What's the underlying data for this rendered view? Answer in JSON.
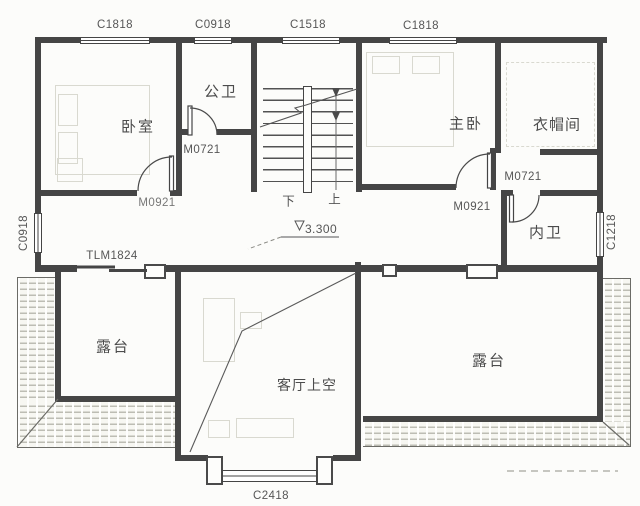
{
  "windows": {
    "top_1": "C1818",
    "top_2": "C0918",
    "top_3": "C1518",
    "top_4": "C1818",
    "left": "C0918",
    "right": "C1218",
    "bottom": "C2418"
  },
  "doors": {
    "public_bath": "M0721",
    "bedroom": "M0921",
    "master": "M0921",
    "ensuite": "M0721",
    "terrace_slide": "TLM1824"
  },
  "rooms": {
    "bedroom": "卧室",
    "public_bath": "公卫",
    "master": "主卧",
    "cloakroom": "衣帽间",
    "ensuite": "内卫",
    "terrace_left": "露台",
    "terrace_right": "露台",
    "living_void": "客厅上空"
  },
  "stairs": {
    "down": "下",
    "up": "上",
    "level": "3.300"
  },
  "colors": {
    "wall_line": "#454545",
    "hatch_line": "#bdbdb4",
    "text": "#565656",
    "paper": "#fcfcfa"
  }
}
